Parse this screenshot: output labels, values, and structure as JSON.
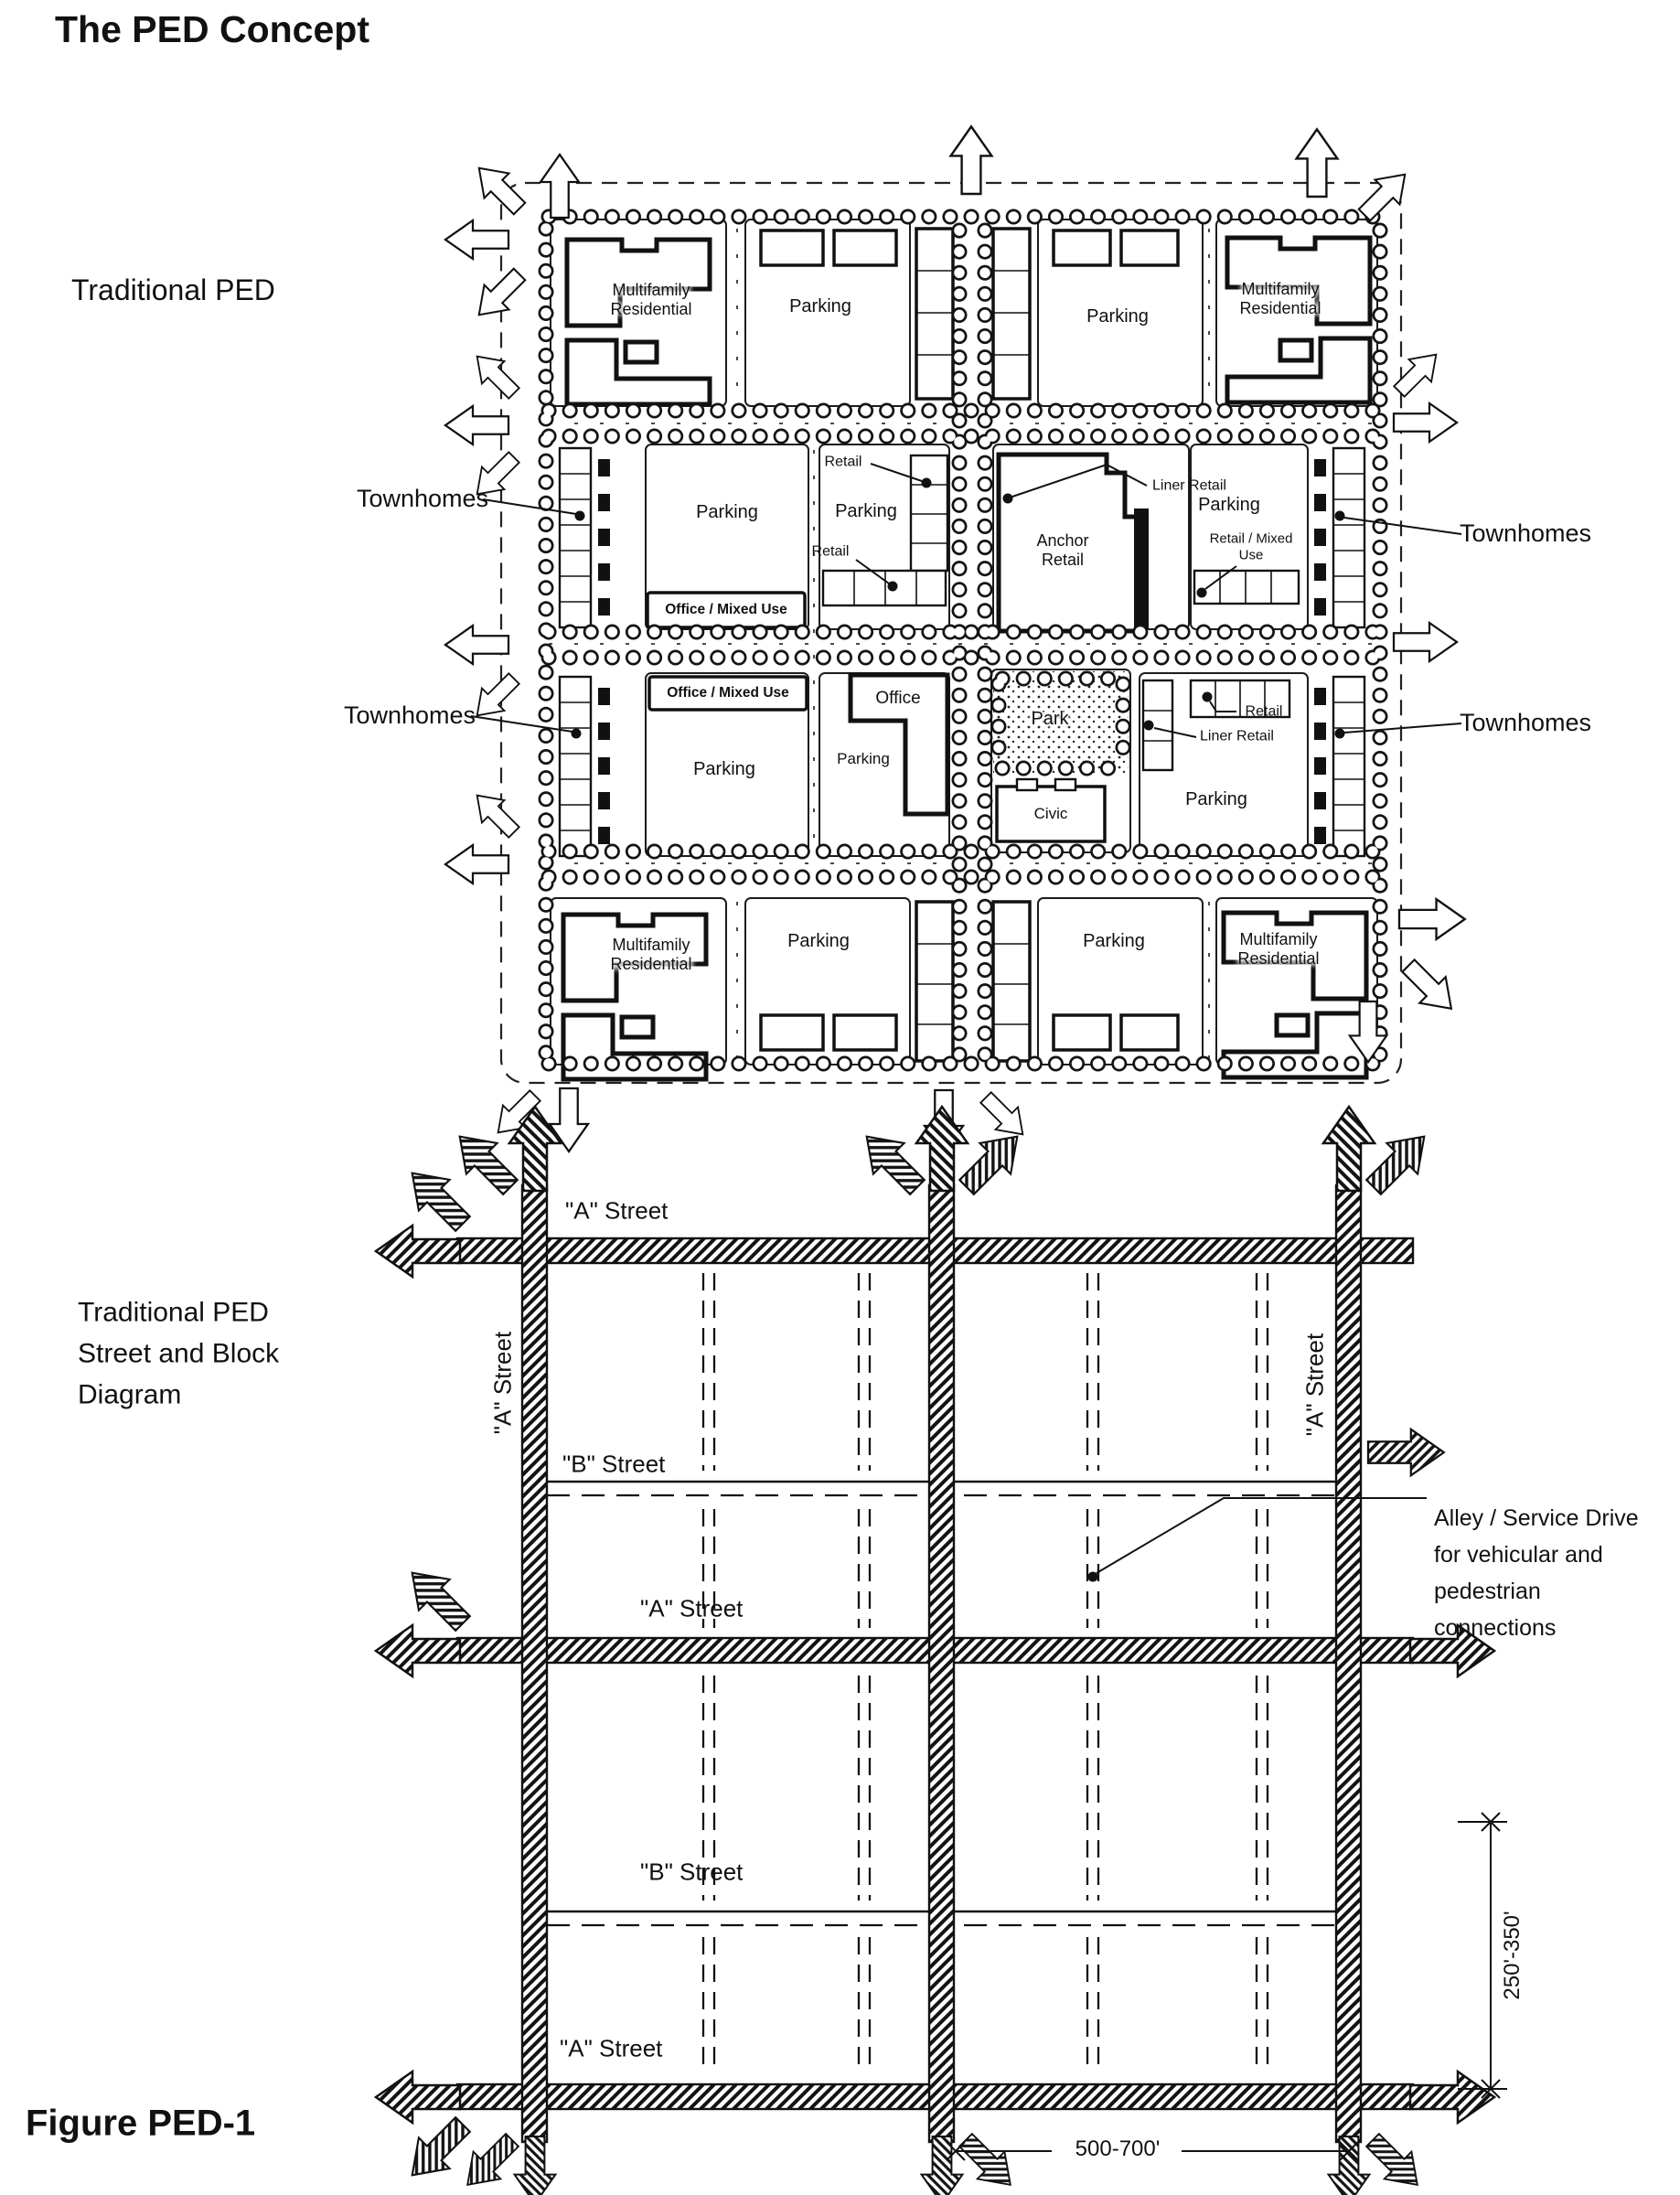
{
  "page": {
    "title": "The PED Concept",
    "figure_label": "Figure PED-1"
  },
  "upper": {
    "caption": "Traditional PED",
    "labels": {
      "multifamily": "Multifamily\nResidential",
      "parking": "Parking",
      "townhomes": "Townhomes",
      "retail": "Retail",
      "anchor_retail": "Anchor\nRetail",
      "liner_retail": "Liner Retail",
      "office_mixed_use": "Office / Mix​ed Use",
      "office": "Office",
      "park": "Park",
      "civic": "Civic",
      "retail_mixed_use": "Retail / Mixed\nUse"
    }
  },
  "lower": {
    "caption": "Traditional PED\nStreet and Block\nDiagram",
    "labels": {
      "a_street": "\"A\" Street",
      "b_street": "\"B\" Street"
    },
    "alley_note": "Alley / Service Drive\nfor vehicular and\npedestrian\nconnections",
    "dimensions": {
      "block_depth": "250'-350'",
      "block_width": "500-700'"
    }
  }
}
